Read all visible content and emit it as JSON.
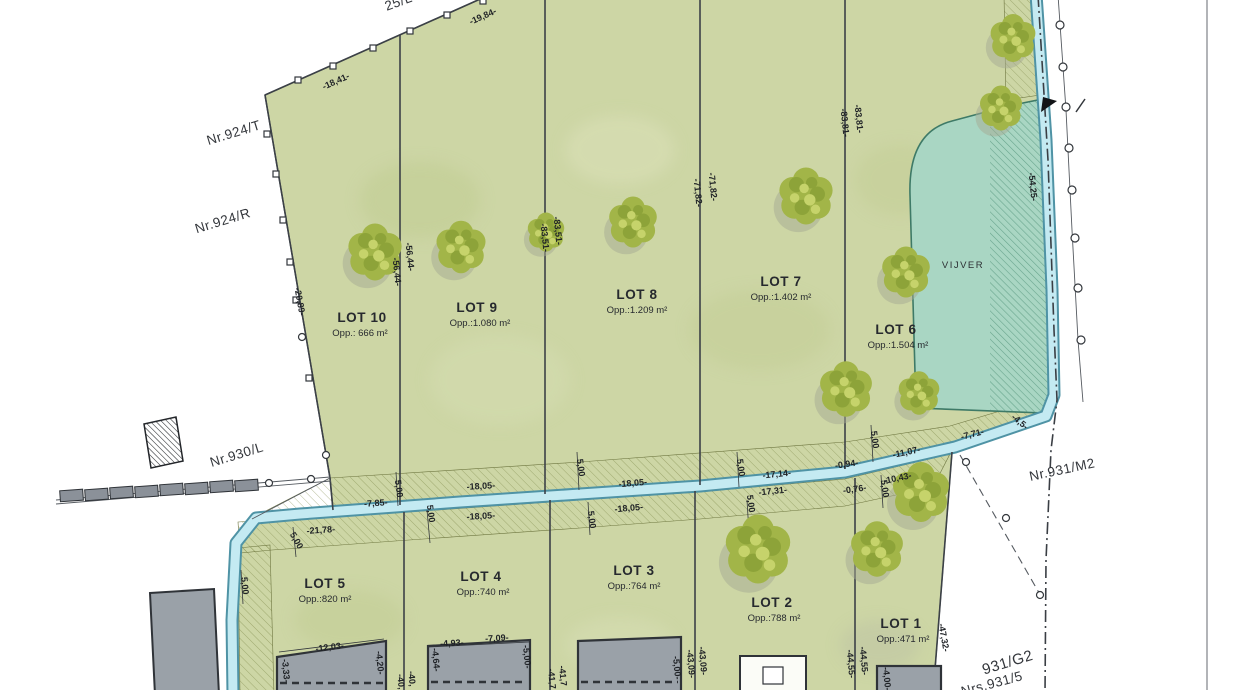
{
  "plan": {
    "pond": {
      "label": "VIJVER"
    },
    "north_lots": [
      {
        "name": "LOT 10",
        "area": "Opp.: 666 m²"
      },
      {
        "name": "LOT 9",
        "area": "Opp.:1.080 m²"
      },
      {
        "name": "LOT 8",
        "area": "Opp.:1.209 m²"
      },
      {
        "name": "LOT 7",
        "area": "Opp.:1.402 m²"
      },
      {
        "name": "LOT 6",
        "area": "Opp.:1.504 m²"
      }
    ],
    "south_lots": [
      {
        "name": "LOT 5",
        "area": "Opp.:820 m²"
      },
      {
        "name": "LOT 4",
        "area": "Opp.:740 m²"
      },
      {
        "name": "LOT 3",
        "area": "Opp.:764 m²"
      },
      {
        "name": "LOT 2",
        "area": "Opp.:788 m²"
      },
      {
        "name": "LOT 1",
        "area": "Opp.:471 m²"
      }
    ],
    "neighbors": {
      "top_partial": "25/L",
      "nr_924_t": "Nr.924/T",
      "nr_924_r": "Nr.924/R",
      "nr_930_l": "Nr.930/L",
      "nr_931_m2": "Nr.931/M2",
      "nr_931_g2": "931/G2",
      "nrs_931_5": "Nrs.931/5"
    },
    "dims": {
      "d1841": "-18,41-",
      "d1984": "-19,84-",
      "d2089": "-20,89-",
      "d5644": "-56,44-",
      "d8351": "-83,51-",
      "d7182": "-71,82-",
      "d8381": "-83,81-",
      "d5425": "-54,25-",
      "d785": "-7,85-",
      "d2178": "-21,78-",
      "d1805": "-18,05-",
      "d1714": "-17,14-",
      "d1731": "-17,31-",
      "d094": "-0,94-",
      "d076": "-0,76-",
      "d1107": "-11,07-",
      "d1043": "-10,43-",
      "d771": "-7,71-",
      "d45": "-4,5-",
      "d500": "5,00",
      "d1203": "-12,03-",
      "d333": "-3,33-",
      "d420": "-4,20-",
      "d493": "-4,93-",
      "d709": "-7,09-",
      "d464": "-4,64-",
      "d5b": "-5,00-",
      "d4309": "-43,09-",
      "d4455": "-44,55-",
      "d4732": "-47,32-",
      "d400": "-4,00-",
      "d40x": "-40,",
      "d417": "-41,7"
    },
    "colors": {
      "parcel_green": "#cdd6a5",
      "stream_blue": "#c4eaf2",
      "stream_edge": "#4f93a5",
      "pond_teal": "#a9d6c3",
      "tree_green": "#a2b548",
      "building_gray": "#8b9199"
    }
  }
}
